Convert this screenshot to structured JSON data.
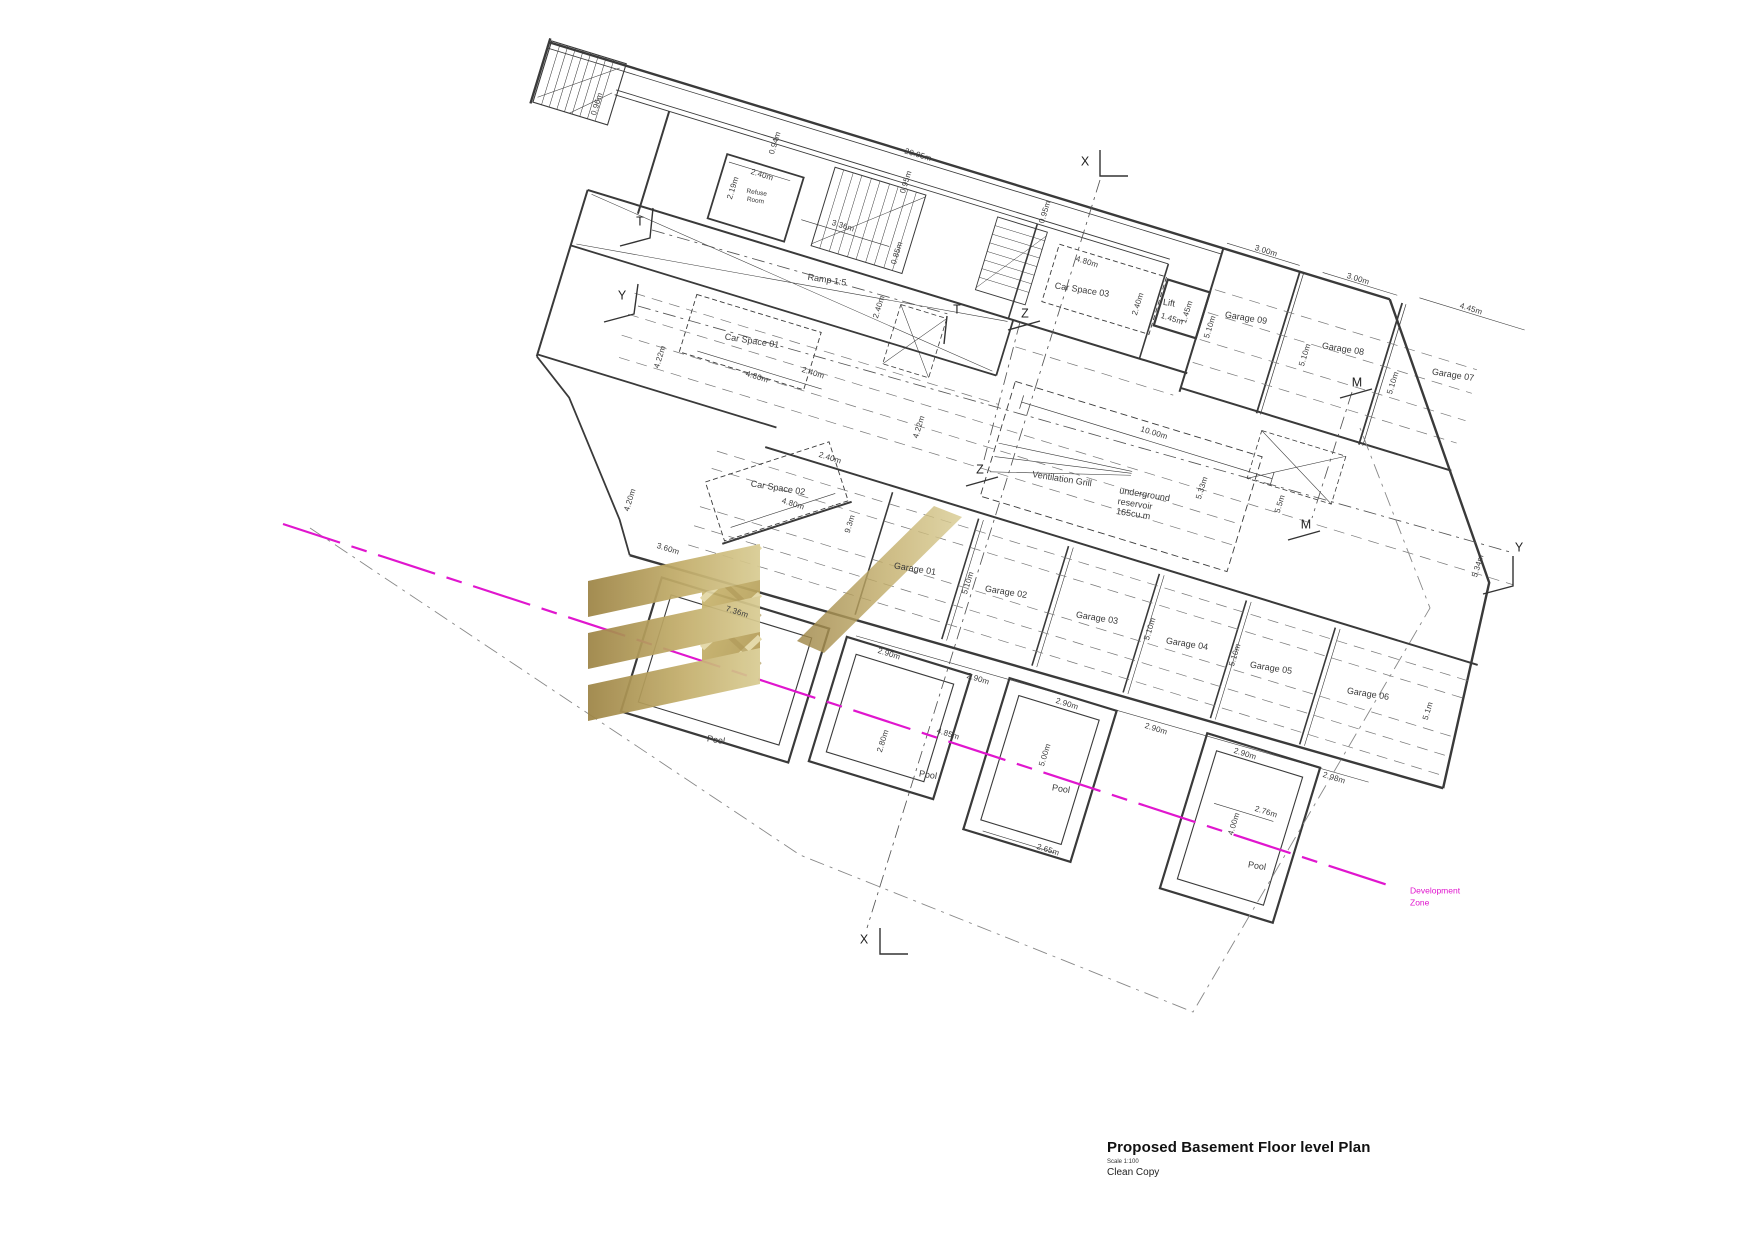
{
  "title_block": {
    "title": "Proposed Basement Floor level Plan",
    "scale": "Scale 1:100",
    "note": "Clean Copy"
  },
  "colors": {
    "wall_line": "#3a3a3a",
    "development_zone_magenta": "#e016ce",
    "logo_gold_dark": "#9d8445",
    "logo_gold_light": "#d9cc93"
  },
  "labels": [
    {
      "t": "0.96m",
      "x": 597,
      "y": 104,
      "r": -73,
      "k": "dim"
    },
    {
      "t": "0.94m",
      "x": 775,
      "y": 143,
      "r": -73,
      "k": "dim"
    },
    {
      "t": "20.95m",
      "x": 918,
      "y": 155,
      "r": 17,
      "k": "dim"
    },
    {
      "t": "2.40m",
      "x": 762,
      "y": 175,
      "r": 17,
      "k": "dim"
    },
    {
      "t": "2.19m",
      "x": 733,
      "y": 188,
      "r": -73,
      "k": "dim"
    },
    {
      "t": "3.36m",
      "x": 843,
      "y": 226,
      "r": 17,
      "k": "dim"
    },
    {
      "t": "0.95m",
      "x": 906,
      "y": 182,
      "r": -73,
      "k": "dim"
    },
    {
      "t": "0.95m",
      "x": 1045,
      "y": 212,
      "r": -73,
      "k": "dim"
    },
    {
      "t": "0.85m",
      "x": 897,
      "y": 253,
      "r": -73,
      "k": "dim"
    },
    {
      "t": "4.22m",
      "x": 660,
      "y": 357,
      "r": -73,
      "k": "dim"
    },
    {
      "t": "4.80m",
      "x": 757,
      "y": 377,
      "r": 17,
      "k": "dim"
    },
    {
      "t": "2.40m",
      "x": 813,
      "y": 373,
      "r": 17,
      "k": "dim"
    },
    {
      "t": "2.40m",
      "x": 879,
      "y": 307,
      "r": -73,
      "k": "dim"
    },
    {
      "t": "4.22m",
      "x": 919,
      "y": 427,
      "r": -73,
      "k": "dim"
    },
    {
      "t": "2.40m",
      "x": 830,
      "y": 458,
      "r": 17,
      "k": "dim"
    },
    {
      "t": "4.80m",
      "x": 793,
      "y": 504,
      "r": 17,
      "k": "dim"
    },
    {
      "t": "4.20m",
      "x": 630,
      "y": 500,
      "r": -73,
      "k": "dim"
    },
    {
      "t": "9.3m",
      "x": 850,
      "y": 524,
      "r": -73,
      "k": "dim"
    },
    {
      "t": "4.80m",
      "x": 1087,
      "y": 262,
      "r": 17,
      "k": "dim"
    },
    {
      "t": "2.40m",
      "x": 1138,
      "y": 304,
      "r": -73,
      "k": "dim"
    },
    {
      "t": "1.45m",
      "x": 1172,
      "y": 319,
      "r": 17,
      "k": "dim"
    },
    {
      "t": "1.45m",
      "x": 1187,
      "y": 312,
      "r": -73,
      "k": "dim"
    },
    {
      "t": "5.10m",
      "x": 1210,
      "y": 327,
      "r": -73,
      "k": "dim"
    },
    {
      "t": "3.00m",
      "x": 1266,
      "y": 251,
      "r": 17,
      "k": "dim"
    },
    {
      "t": "3.00m",
      "x": 1358,
      "y": 279,
      "r": 17,
      "k": "dim"
    },
    {
      "t": "4.45m",
      "x": 1471,
      "y": 309,
      "r": 17,
      "k": "dim"
    },
    {
      "t": "5.10m",
      "x": 1305,
      "y": 355,
      "r": -73,
      "k": "dim"
    },
    {
      "t": "5.10m",
      "x": 1393,
      "y": 383,
      "r": -73,
      "k": "dim"
    },
    {
      "t": "10.00m",
      "x": 1154,
      "y": 433,
      "r": 17,
      "k": "dim"
    },
    {
      "t": "5.33m",
      "x": 1202,
      "y": 488,
      "r": -73,
      "k": "dim"
    },
    {
      "t": "5.5m",
      "x": 1280,
      "y": 504,
      "r": -73,
      "k": "dim"
    },
    {
      "t": "5.10m",
      "x": 968,
      "y": 583,
      "r": -73,
      "k": "dim"
    },
    {
      "t": "5.10m",
      "x": 1150,
      "y": 629,
      "r": -73,
      "k": "dim"
    },
    {
      "t": "5.10m",
      "x": 1235,
      "y": 655,
      "r": -73,
      "k": "dim"
    },
    {
      "t": "5.1m",
      "x": 1428,
      "y": 711,
      "r": -73,
      "k": "dim"
    },
    {
      "t": "5.34m",
      "x": 1478,
      "y": 566,
      "r": -73,
      "k": "dim"
    },
    {
      "t": "3.60m",
      "x": 668,
      "y": 549,
      "r": 17,
      "k": "dim"
    },
    {
      "t": "7.36m",
      "x": 737,
      "y": 612,
      "r": 17,
      "k": "dim"
    },
    {
      "t": "2.90m",
      "x": 889,
      "y": 654,
      "r": 17,
      "k": "dim"
    },
    {
      "t": "2.90m",
      "x": 978,
      "y": 679,
      "r": 17,
      "k": "dim"
    },
    {
      "t": "2.90m",
      "x": 1067,
      "y": 704,
      "r": 17,
      "k": "dim"
    },
    {
      "t": "2.90m",
      "x": 1156,
      "y": 729,
      "r": 17,
      "k": "dim"
    },
    {
      "t": "2.90m",
      "x": 1245,
      "y": 754,
      "r": 17,
      "k": "dim"
    },
    {
      "t": "2.98m",
      "x": 1334,
      "y": 778,
      "r": 17,
      "k": "dim"
    },
    {
      "t": "2.80m",
      "x": 883,
      "y": 741,
      "r": -73,
      "k": "dim"
    },
    {
      "t": "4.85m",
      "x": 948,
      "y": 734,
      "r": 17,
      "k": "dim"
    },
    {
      "t": "5.00m",
      "x": 1045,
      "y": 755,
      "r": -73,
      "k": "dim"
    },
    {
      "t": "2.65m",
      "x": 1048,
      "y": 850,
      "r": 17,
      "k": "dim"
    },
    {
      "t": "2.76m",
      "x": 1266,
      "y": 812,
      "r": 17,
      "k": "dim"
    },
    {
      "t": "4.00m",
      "x": 1234,
      "y": 824,
      "r": -73,
      "k": "dim"
    },
    {
      "t": "Refuse\nRoom",
      "x": 756,
      "y": 197,
      "r": 9,
      "k": "room-sm"
    },
    {
      "t": "Ramp 1:5",
      "x": 827,
      "y": 280,
      "r": 9,
      "k": "room"
    },
    {
      "t": "Car Space 01",
      "x": 752,
      "y": 341,
      "r": 9,
      "k": "room"
    },
    {
      "t": "Car Space 02",
      "x": 778,
      "y": 488,
      "r": 9,
      "k": "room"
    },
    {
      "t": "Car Space 03",
      "x": 1082,
      "y": 290,
      "r": 9,
      "k": "room"
    },
    {
      "t": "Lift",
      "x": 1169,
      "y": 303,
      "r": 9,
      "k": "room"
    },
    {
      "t": "Garage 09",
      "x": 1246,
      "y": 318,
      "r": 9,
      "k": "room"
    },
    {
      "t": "Garage 08",
      "x": 1343,
      "y": 349,
      "r": 9,
      "k": "room"
    },
    {
      "t": "Garage 07",
      "x": 1453,
      "y": 375,
      "r": 9,
      "k": "room"
    },
    {
      "t": "Ventilation Grill",
      "x": 1062,
      "y": 479,
      "r": 9,
      "k": "room"
    },
    {
      "t": "underground\nreservoir\n165cu.m",
      "x": 1143,
      "y": 505,
      "r": 9,
      "k": "room"
    },
    {
      "t": "Garage 01",
      "x": 915,
      "y": 569,
      "r": 9,
      "k": "room"
    },
    {
      "t": "Garage 02",
      "x": 1006,
      "y": 592,
      "r": 9,
      "k": "room"
    },
    {
      "t": "Garage 03",
      "x": 1097,
      "y": 618,
      "r": 9,
      "k": "room"
    },
    {
      "t": "Garage 04",
      "x": 1187,
      "y": 644,
      "r": 9,
      "k": "room"
    },
    {
      "t": "Garage 05",
      "x": 1271,
      "y": 668,
      "r": 9,
      "k": "room"
    },
    {
      "t": "Garage 06",
      "x": 1368,
      "y": 694,
      "r": 9,
      "k": "room"
    },
    {
      "t": "Pool",
      "x": 716,
      "y": 740,
      "r": 9,
      "k": "room"
    },
    {
      "t": "Pool",
      "x": 928,
      "y": 775,
      "r": 9,
      "k": "room"
    },
    {
      "t": "Pool",
      "x": 1061,
      "y": 789,
      "r": 9,
      "k": "room"
    },
    {
      "t": "Pool",
      "x": 1257,
      "y": 866,
      "r": 9,
      "k": "room"
    },
    {
      "t": "X",
      "x": 1085,
      "y": 162,
      "r": 0,
      "k": "marker"
    },
    {
      "t": "T",
      "x": 640,
      "y": 222,
      "r": 0,
      "k": "marker"
    },
    {
      "t": "Y",
      "x": 622,
      "y": 296,
      "r": 0,
      "k": "marker"
    },
    {
      "t": "T",
      "x": 957,
      "y": 310,
      "r": 0,
      "k": "marker"
    },
    {
      "t": "Z",
      "x": 1025,
      "y": 314,
      "r": 0,
      "k": "marker"
    },
    {
      "t": "Z",
      "x": 980,
      "y": 470,
      "r": 0,
      "k": "marker"
    },
    {
      "t": "M",
      "x": 1357,
      "y": 383,
      "r": 0,
      "k": "marker"
    },
    {
      "t": "M",
      "x": 1306,
      "y": 525,
      "r": 0,
      "k": "marker"
    },
    {
      "t": "Y",
      "x": 1519,
      "y": 548,
      "r": 0,
      "k": "marker"
    },
    {
      "t": "X",
      "x": 864,
      "y": 940,
      "r": 0,
      "k": "marker"
    },
    {
      "t": "Development\nZone",
      "x": 1410,
      "y": 897,
      "r": 0,
      "k": "dev"
    }
  ]
}
